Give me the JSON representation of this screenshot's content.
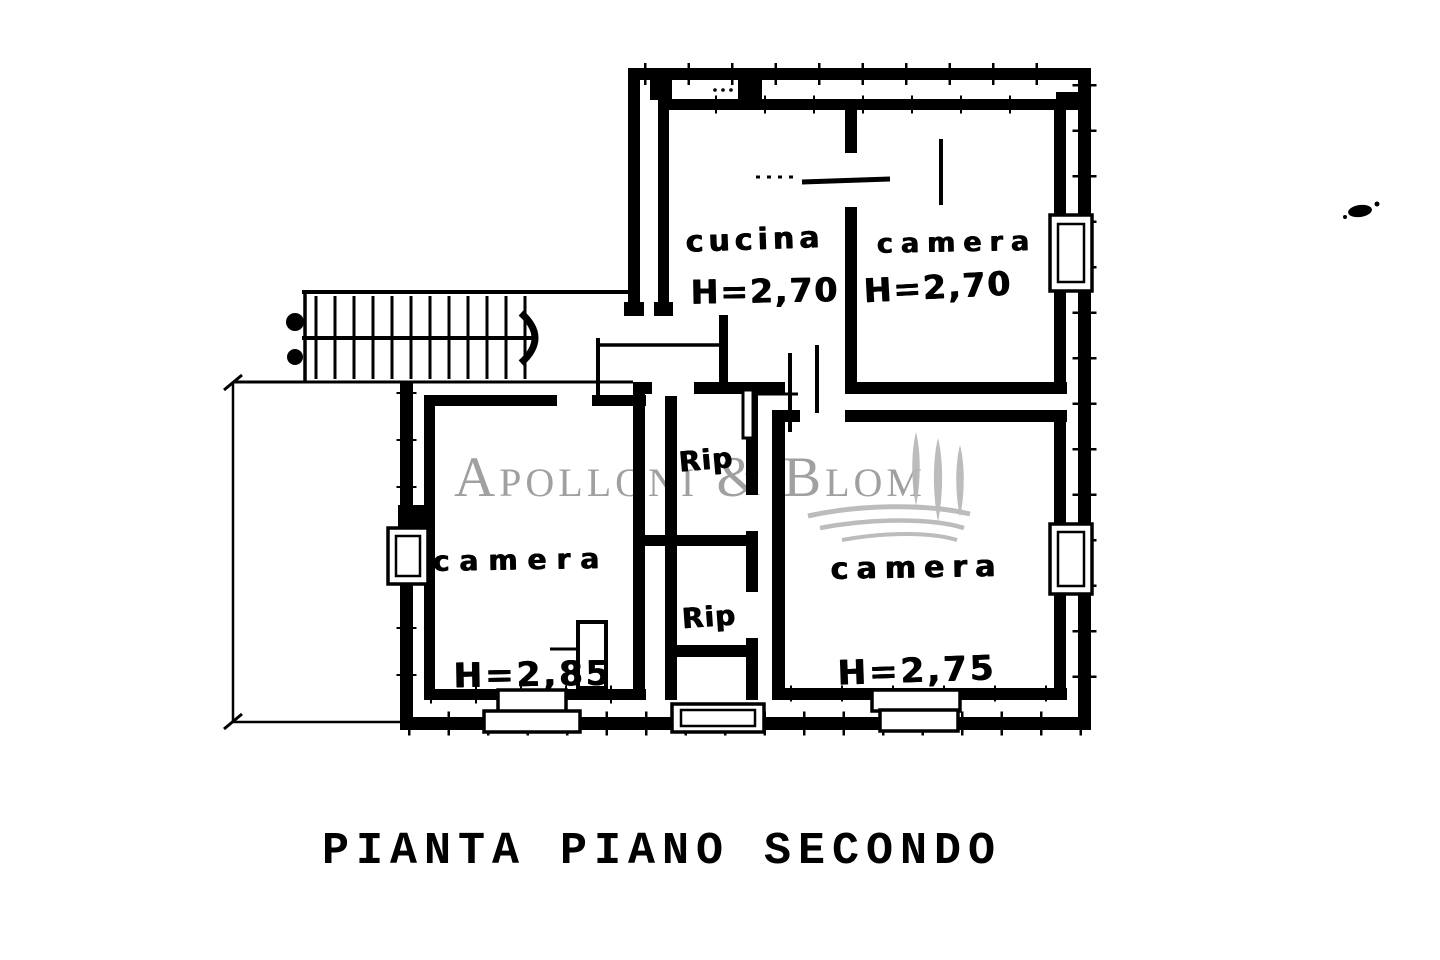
{
  "plan": {
    "title": "PIANTA PIANO SECONDO",
    "rooms": [
      {
        "id": "cucina",
        "name": "cucina",
        "height_label": "H=2,70"
      },
      {
        "id": "camera-nord",
        "name": "camera",
        "height_label": "H=2,70"
      },
      {
        "id": "camera-ovest",
        "name": "camera",
        "height_label": "H=2,85"
      },
      {
        "id": "camera-est",
        "name": "camera",
        "height_label": "H=2,75"
      },
      {
        "id": "ripostiglio-1",
        "name": "Rip"
      },
      {
        "id": "ripostiglio-2",
        "name": "Rip"
      }
    ]
  },
  "watermark": {
    "text": "Apolloni & Blom"
  },
  "colors": {
    "ink": "#000000",
    "paper": "#ffffff",
    "watermark_text": "#939393",
    "watermark_logo": "#b7b7b7"
  }
}
